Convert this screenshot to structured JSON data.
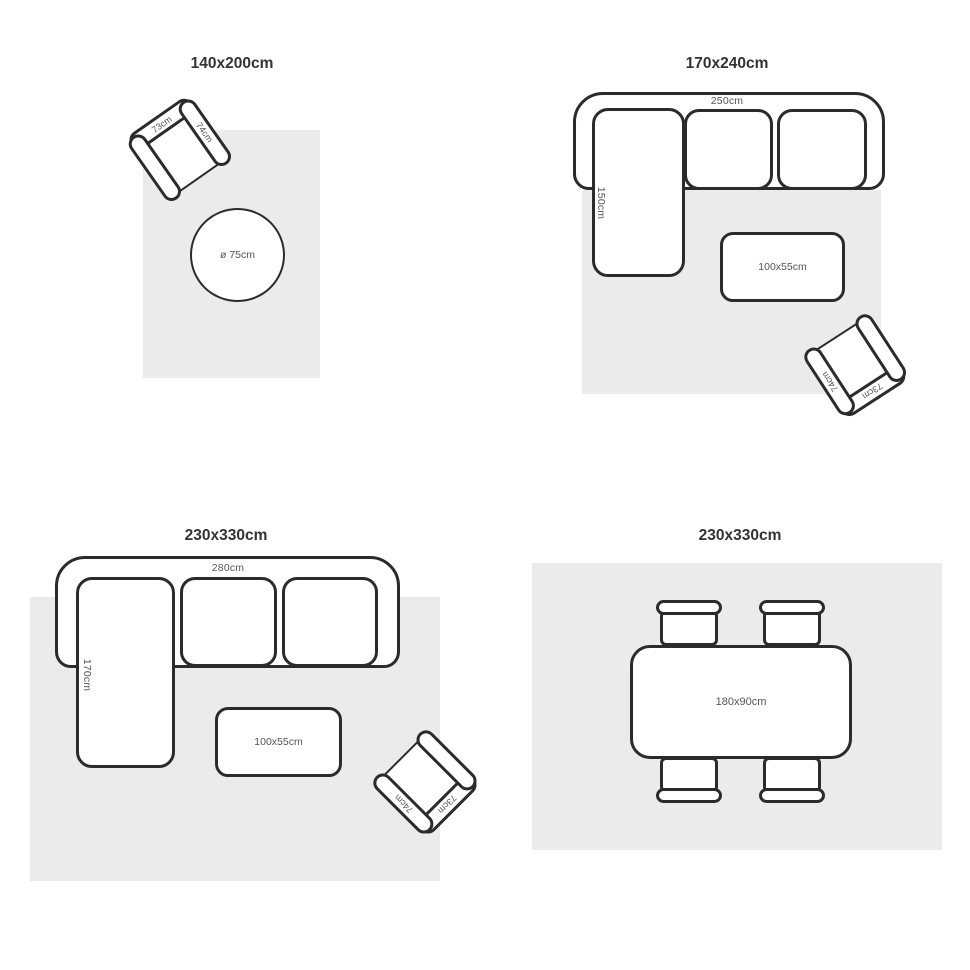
{
  "colors": {
    "rug": "#ebebeb",
    "outline": "#2b2b2b",
    "dimension_text": "#555555",
    "title_text": "#333333"
  },
  "panels": {
    "top_left": {
      "title": "140x200cm",
      "armchair": {
        "width_label": "73cm",
        "depth_label": "74cm"
      },
      "round_table": {
        "label": "ø 75cm"
      }
    },
    "top_right": {
      "title": "170x240cm",
      "sofa": {
        "width_label": "250cm",
        "depth_label": "150cm"
      },
      "coffee_table": {
        "label": "100x55cm"
      },
      "armchair": {
        "width_label": "73cm",
        "depth_label": "74cm"
      }
    },
    "bottom_left": {
      "title": "230x330cm",
      "sofa": {
        "width_label": "280cm",
        "depth_label": "170cm"
      },
      "coffee_table": {
        "label": "100x55cm"
      },
      "armchair": {
        "width_label": "73cm",
        "depth_label": "74cm"
      }
    },
    "bottom_right": {
      "title": "230x330cm",
      "dining_table": {
        "label": "180x90cm"
      }
    }
  }
}
